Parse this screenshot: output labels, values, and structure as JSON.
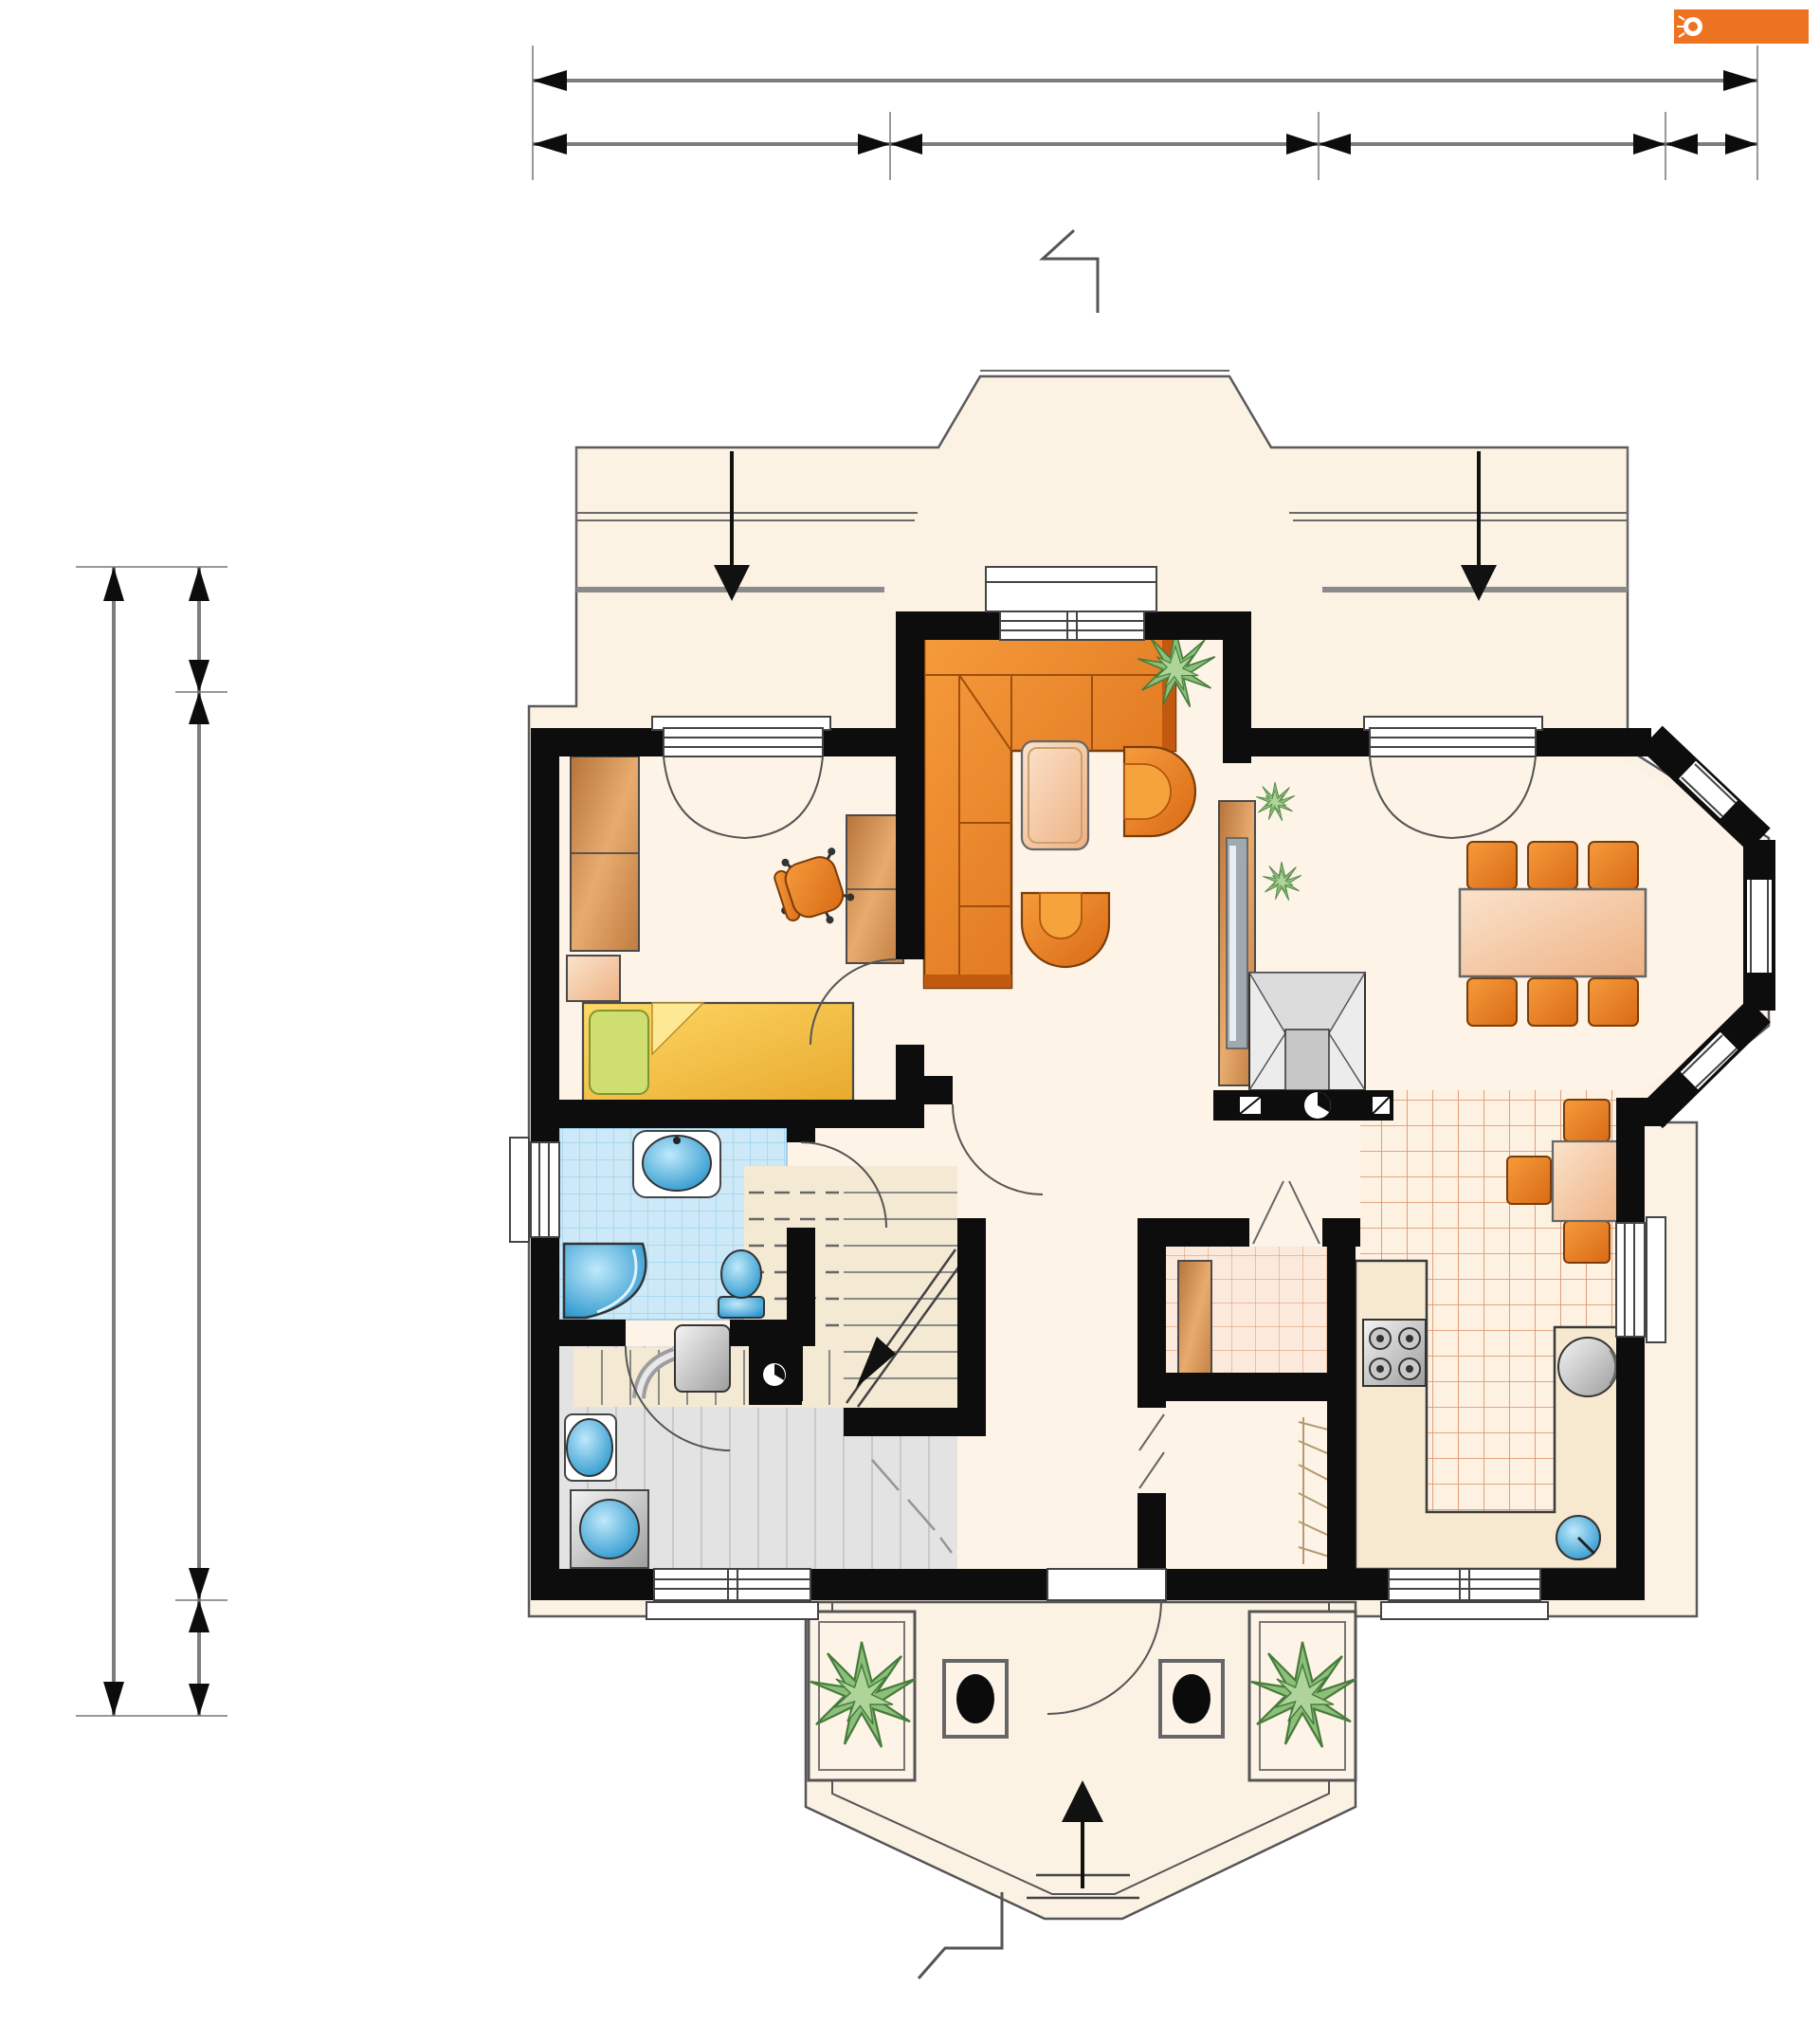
{
  "brand": {
    "logo_text": "ARCHETON",
    "registered_mark": "®",
    "logo_bg": "#ee7320"
  },
  "dimensions": {
    "top": {
      "total": "12,0",
      "segments": [
        {
          "label": "3,5"
        },
        {
          "label": "4,2"
        },
        {
          "label": "3,4"
        },
        {
          "label": "0,9"
        }
      ]
    },
    "left": {
      "total": "11,0",
      "segments": [
        {
          "label": "1,2"
        },
        {
          "label": "8,7"
        },
        {
          "label": "1,1"
        }
      ]
    }
  },
  "section_markers": {
    "top": "A",
    "bottom": "A"
  },
  "rooms": [
    {
      "id": "bedroom",
      "area": "11,2 m²"
    },
    {
      "id": "living-room",
      "area": "28,9 m²"
    },
    {
      "id": "bathroom",
      "area": "3,6 m²"
    },
    {
      "id": "corridor",
      "area": "9,2 m²"
    },
    {
      "id": "stairs",
      "area": "3,1 m²"
    },
    {
      "id": "hall",
      "area": "4,6 m²"
    },
    {
      "id": "pantry",
      "area": "1,6 m²"
    },
    {
      "id": "closet",
      "area": "1,6 m²"
    },
    {
      "id": "kitchen",
      "area": "10,4 m²"
    },
    {
      "id": "utility-room",
      "area": "6,9 m²/8,1 m²"
    }
  ],
  "colors": {
    "walls": "#0d0d0d",
    "roof_fill": "#fcf2e4",
    "floor_fill": "#fdf3e7",
    "furniture_orange": "#e8792a",
    "wood_brown": "#c98347",
    "bed_yellow": "#f2c445",
    "pillow_green": "#cede70",
    "bath_blue_tile": "#cde9f7",
    "fixture_blue": "#45b7e8",
    "kitchen_tile_grid": "#dd8a5f",
    "utility_gray": "#e3e3e3",
    "logo_orange": "#ee7320"
  }
}
